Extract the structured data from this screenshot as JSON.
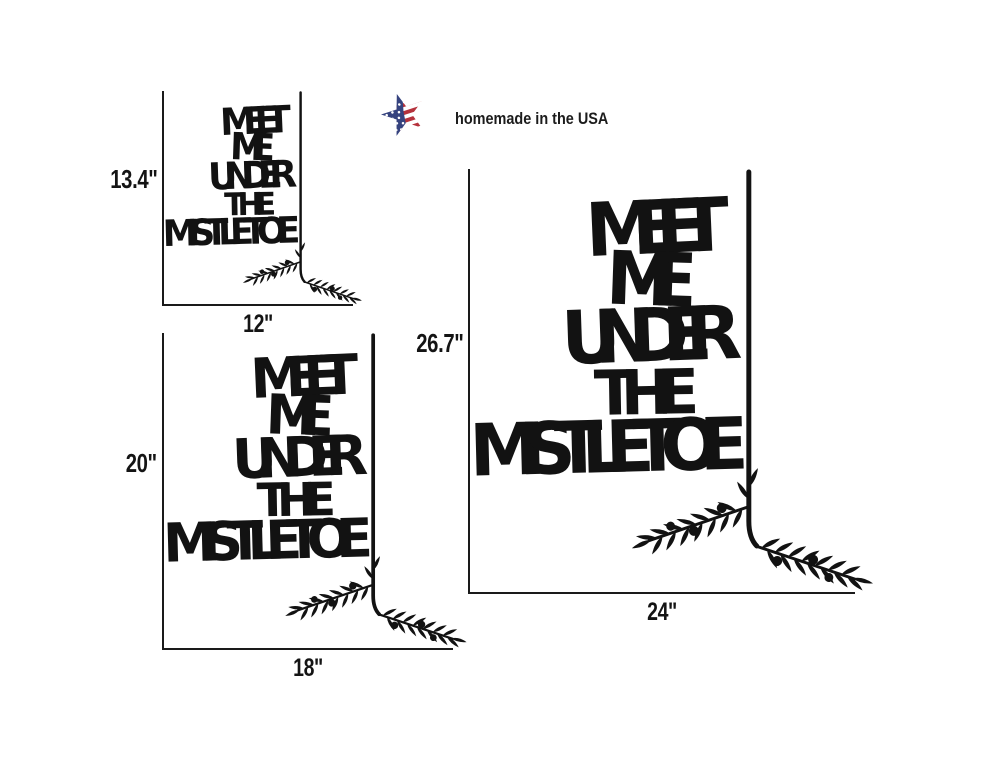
{
  "page": {
    "background_color": "#ffffff",
    "ink_color": "#121212",
    "measure_line_color": "#1a1a1a"
  },
  "badge": {
    "label": "homemade in the USA",
    "star_icon": "usa-flag-star",
    "flag_blue": "#36437f",
    "flag_red": "#b5323c",
    "flag_white": "#ffffff",
    "text_color": "#1c1c1c"
  },
  "artwork": {
    "lines": [
      "MEET",
      "ME",
      "UNDER",
      "THE",
      "MISTLETOE"
    ],
    "decoration": "olive-branch-with-berries",
    "color": "#121212"
  },
  "signs": [
    {
      "name": "small",
      "height_label": "13.4\"",
      "width_label": "12\""
    },
    {
      "name": "medium",
      "height_label": "20\"",
      "width_label": "18\""
    },
    {
      "name": "large",
      "height_label": "26.7\"",
      "width_label": "24\""
    }
  ]
}
